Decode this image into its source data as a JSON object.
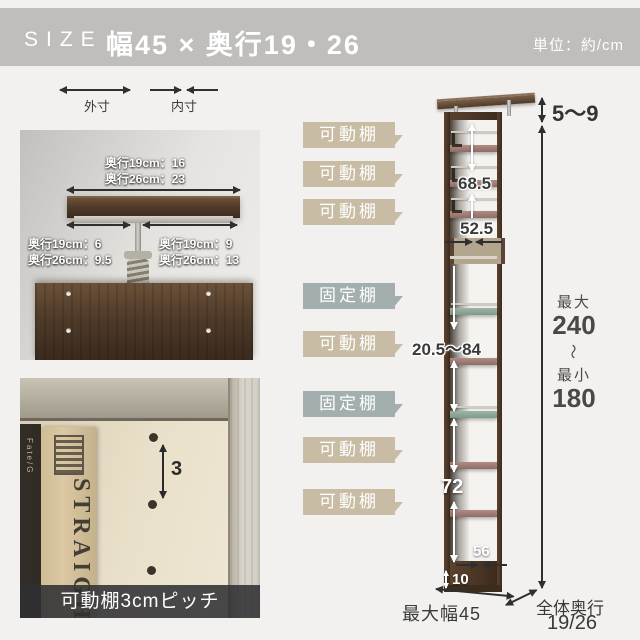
{
  "header": {
    "size_label": "SIZE",
    "title": "幅45 × 奥行19・26",
    "unit": "単位：約/cm"
  },
  "legend": {
    "outer": "外寸",
    "inner": "内寸"
  },
  "photo_top": {
    "width_dims": [
      "奥行19cm：16",
      "奥行26cm：23"
    ],
    "left_dims": [
      "奥行19cm：6",
      "奥行26cm：9.5"
    ],
    "right_dims": [
      "奥行19cm：9",
      "奥行26cm：13"
    ]
  },
  "photo_bottom": {
    "pitch_value": "3",
    "caption": "可動棚3cmピッチ",
    "book_spine": "STRAIGHT",
    "book_spine_small": "Fate/G"
  },
  "diagram": {
    "shelf_labels": [
      {
        "text": "可動棚",
        "type": "movable"
      },
      {
        "text": "可動棚",
        "type": "movable"
      },
      {
        "text": "可動棚",
        "type": "movable"
      },
      {
        "text": "固定棚",
        "type": "fixed"
      },
      {
        "text": "可動棚",
        "type": "movable"
      },
      {
        "text": "固定棚",
        "type": "fixed"
      },
      {
        "text": "可動棚",
        "type": "movable"
      },
      {
        "text": "可動棚",
        "type": "movable"
      }
    ],
    "measurements": {
      "top_gap": "5〜9",
      "upper_height": "68.5",
      "upper_inner": "52.5",
      "shelf_range": "20.5〜84",
      "lower_height": "72",
      "bottom_inner": "56",
      "base_height": "10",
      "max_width": "最大幅45",
      "height_max_label": "最大",
      "height_max": "240",
      "height_tilde": "〜",
      "height_min_label": "最小",
      "height_min": "180",
      "depth_label": "全体奥行",
      "depth_value": "19/26"
    }
  },
  "colors": {
    "header_bg": "#bfbebb",
    "page_bg": "#f2f1ef",
    "label_movable": "#c8bda4",
    "label_fixed": "#a3aeae",
    "walnut": "#4a3726",
    "shelf_movable": "#a5827c",
    "shelf_fixed": "#8ea89a",
    "text_dark": "#3a3a3a"
  }
}
